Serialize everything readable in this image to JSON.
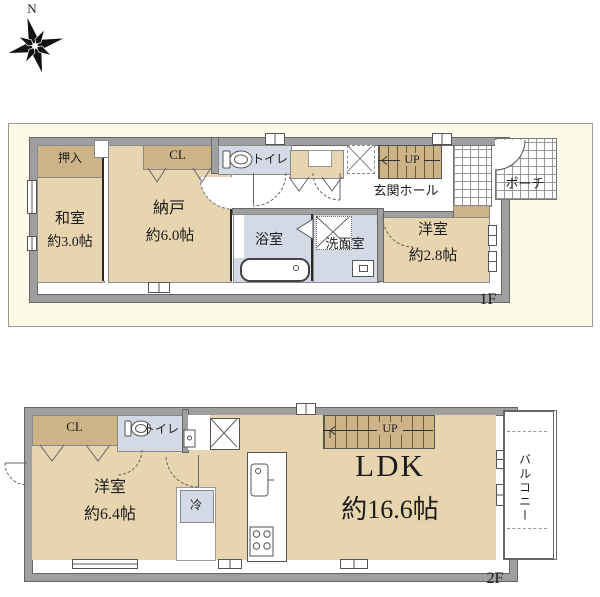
{
  "compass": {
    "north": "N"
  },
  "floor1": {
    "label": "1F",
    "oshiire": "押入",
    "washitsu": "和室",
    "washitsu_size": "約3.0帖",
    "nando": "納戸",
    "nando_size": "約6.0帖",
    "closet": "CL",
    "toilet": "トイレ",
    "bath": "浴室",
    "washroom": "洗面室",
    "entrance_hall": "玄関ホール",
    "stairs": "UP",
    "youshitsu": "洋室",
    "youshitsu_size": "約2.8帖",
    "porch": "ポーチ"
  },
  "floor2": {
    "label": "2F",
    "closet": "CL",
    "toilet": "トイレ",
    "youshitsu": "洋室",
    "youshitsu_size": "約6.4帖",
    "fridge": "冷",
    "ldk": "LDK",
    "ldk_size": "約16.6帖",
    "stairs": "UP",
    "balcony": "バルコニー"
  },
  "colors": {
    "room_tan": "#E6D5AF",
    "closet_tan": "#CDB488",
    "wet_area_blue": "#D4D9E6",
    "wall_gray": "#9F9F9F",
    "panel_cream": "#FDFBE8"
  }
}
